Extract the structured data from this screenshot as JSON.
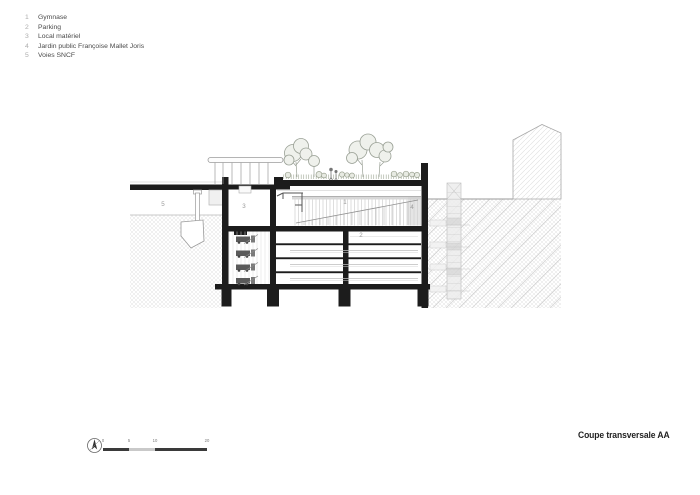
{
  "legend": {
    "items": [
      {
        "num": "1",
        "label": "Gymnase"
      },
      {
        "num": "2",
        "label": "Parking"
      },
      {
        "num": "3",
        "label": "Local matériel"
      },
      {
        "num": "4",
        "label": "Jardin public Françoise Mallet Joris"
      },
      {
        "num": "5",
        "label": "Voies SNCF"
      }
    ]
  },
  "drawing": {
    "labels": {
      "gymnase": "1",
      "parking": "2",
      "local": "3",
      "jardin": "4",
      "voies": "5"
    }
  },
  "scalebar": {
    "ticks": [
      "0",
      "5",
      "10",
      "20"
    ],
    "north_letter": "N"
  },
  "titleblock": {
    "title": "Coupe transversale AA"
  },
  "colors": {
    "cut_black": "#1c1c1c",
    "line_gray": "#9a9a9a",
    "hatch_gray": "#dddddd",
    "tree_green_gray": "#8f968a",
    "label_gray": "#9a9a9a",
    "text_dark": "#4a4a4a"
  }
}
